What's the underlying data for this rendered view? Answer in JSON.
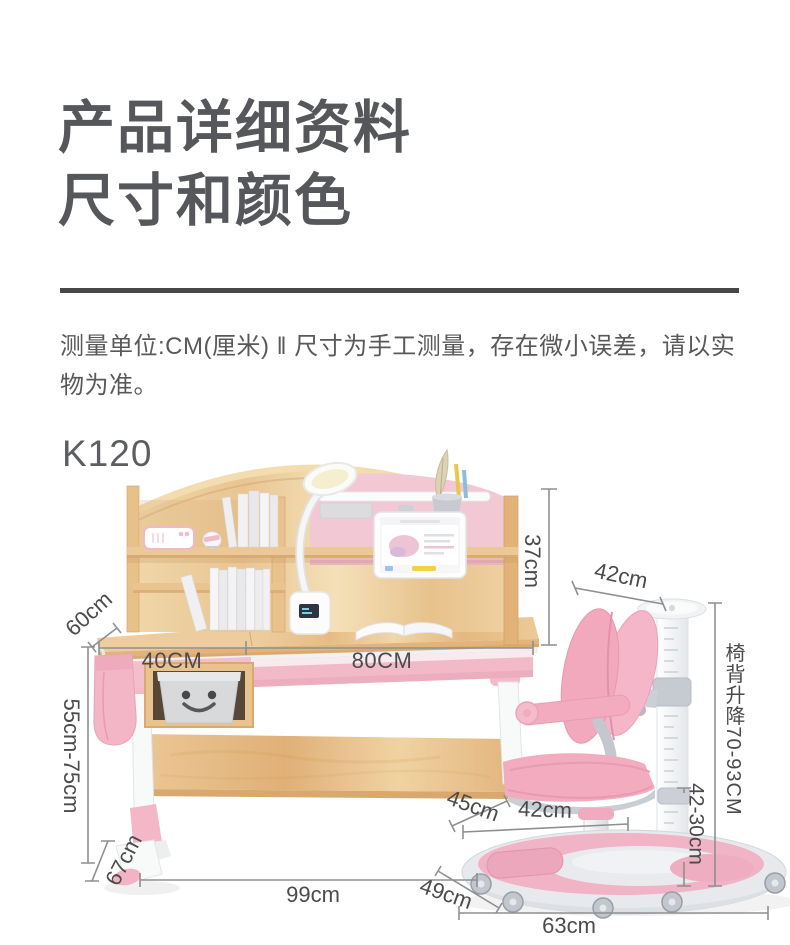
{
  "header": {
    "title_line1": "产品详细资料",
    "title_line2": "尺寸和颜色"
  },
  "note": {
    "text": "测量单位:CM(厘米) ‖ 尺寸为手工测量，存在微小误差，请以实物为准。"
  },
  "product": {
    "model": "K120"
  },
  "dimensions": {
    "hutch_height": "37cm",
    "chair_backrest_width": "42cm",
    "desk_depth": "60cm",
    "left_section_width": "40CM",
    "right_section_width": "80CM",
    "desk_height_range": "55cm-75cm",
    "chair_back_lift": "椅背升降70-93CM",
    "seat_lift_range": "42-30cm",
    "seat_depth": "45cm",
    "seat_width": "42cm",
    "foot_length": "67cm",
    "desk_width": "99cm",
    "base_depth": "49cm",
    "base_width": "63cm"
  },
  "colors": {
    "accent_pink": "#f3afc2",
    "panel_pink": "#f3c8d5",
    "wood": "#ecc795",
    "hardware_gray": "#c6cad1",
    "dimension_line": "#8e8f91",
    "dimension_text": "#4b4b4d",
    "heading_text": "#56575a"
  }
}
